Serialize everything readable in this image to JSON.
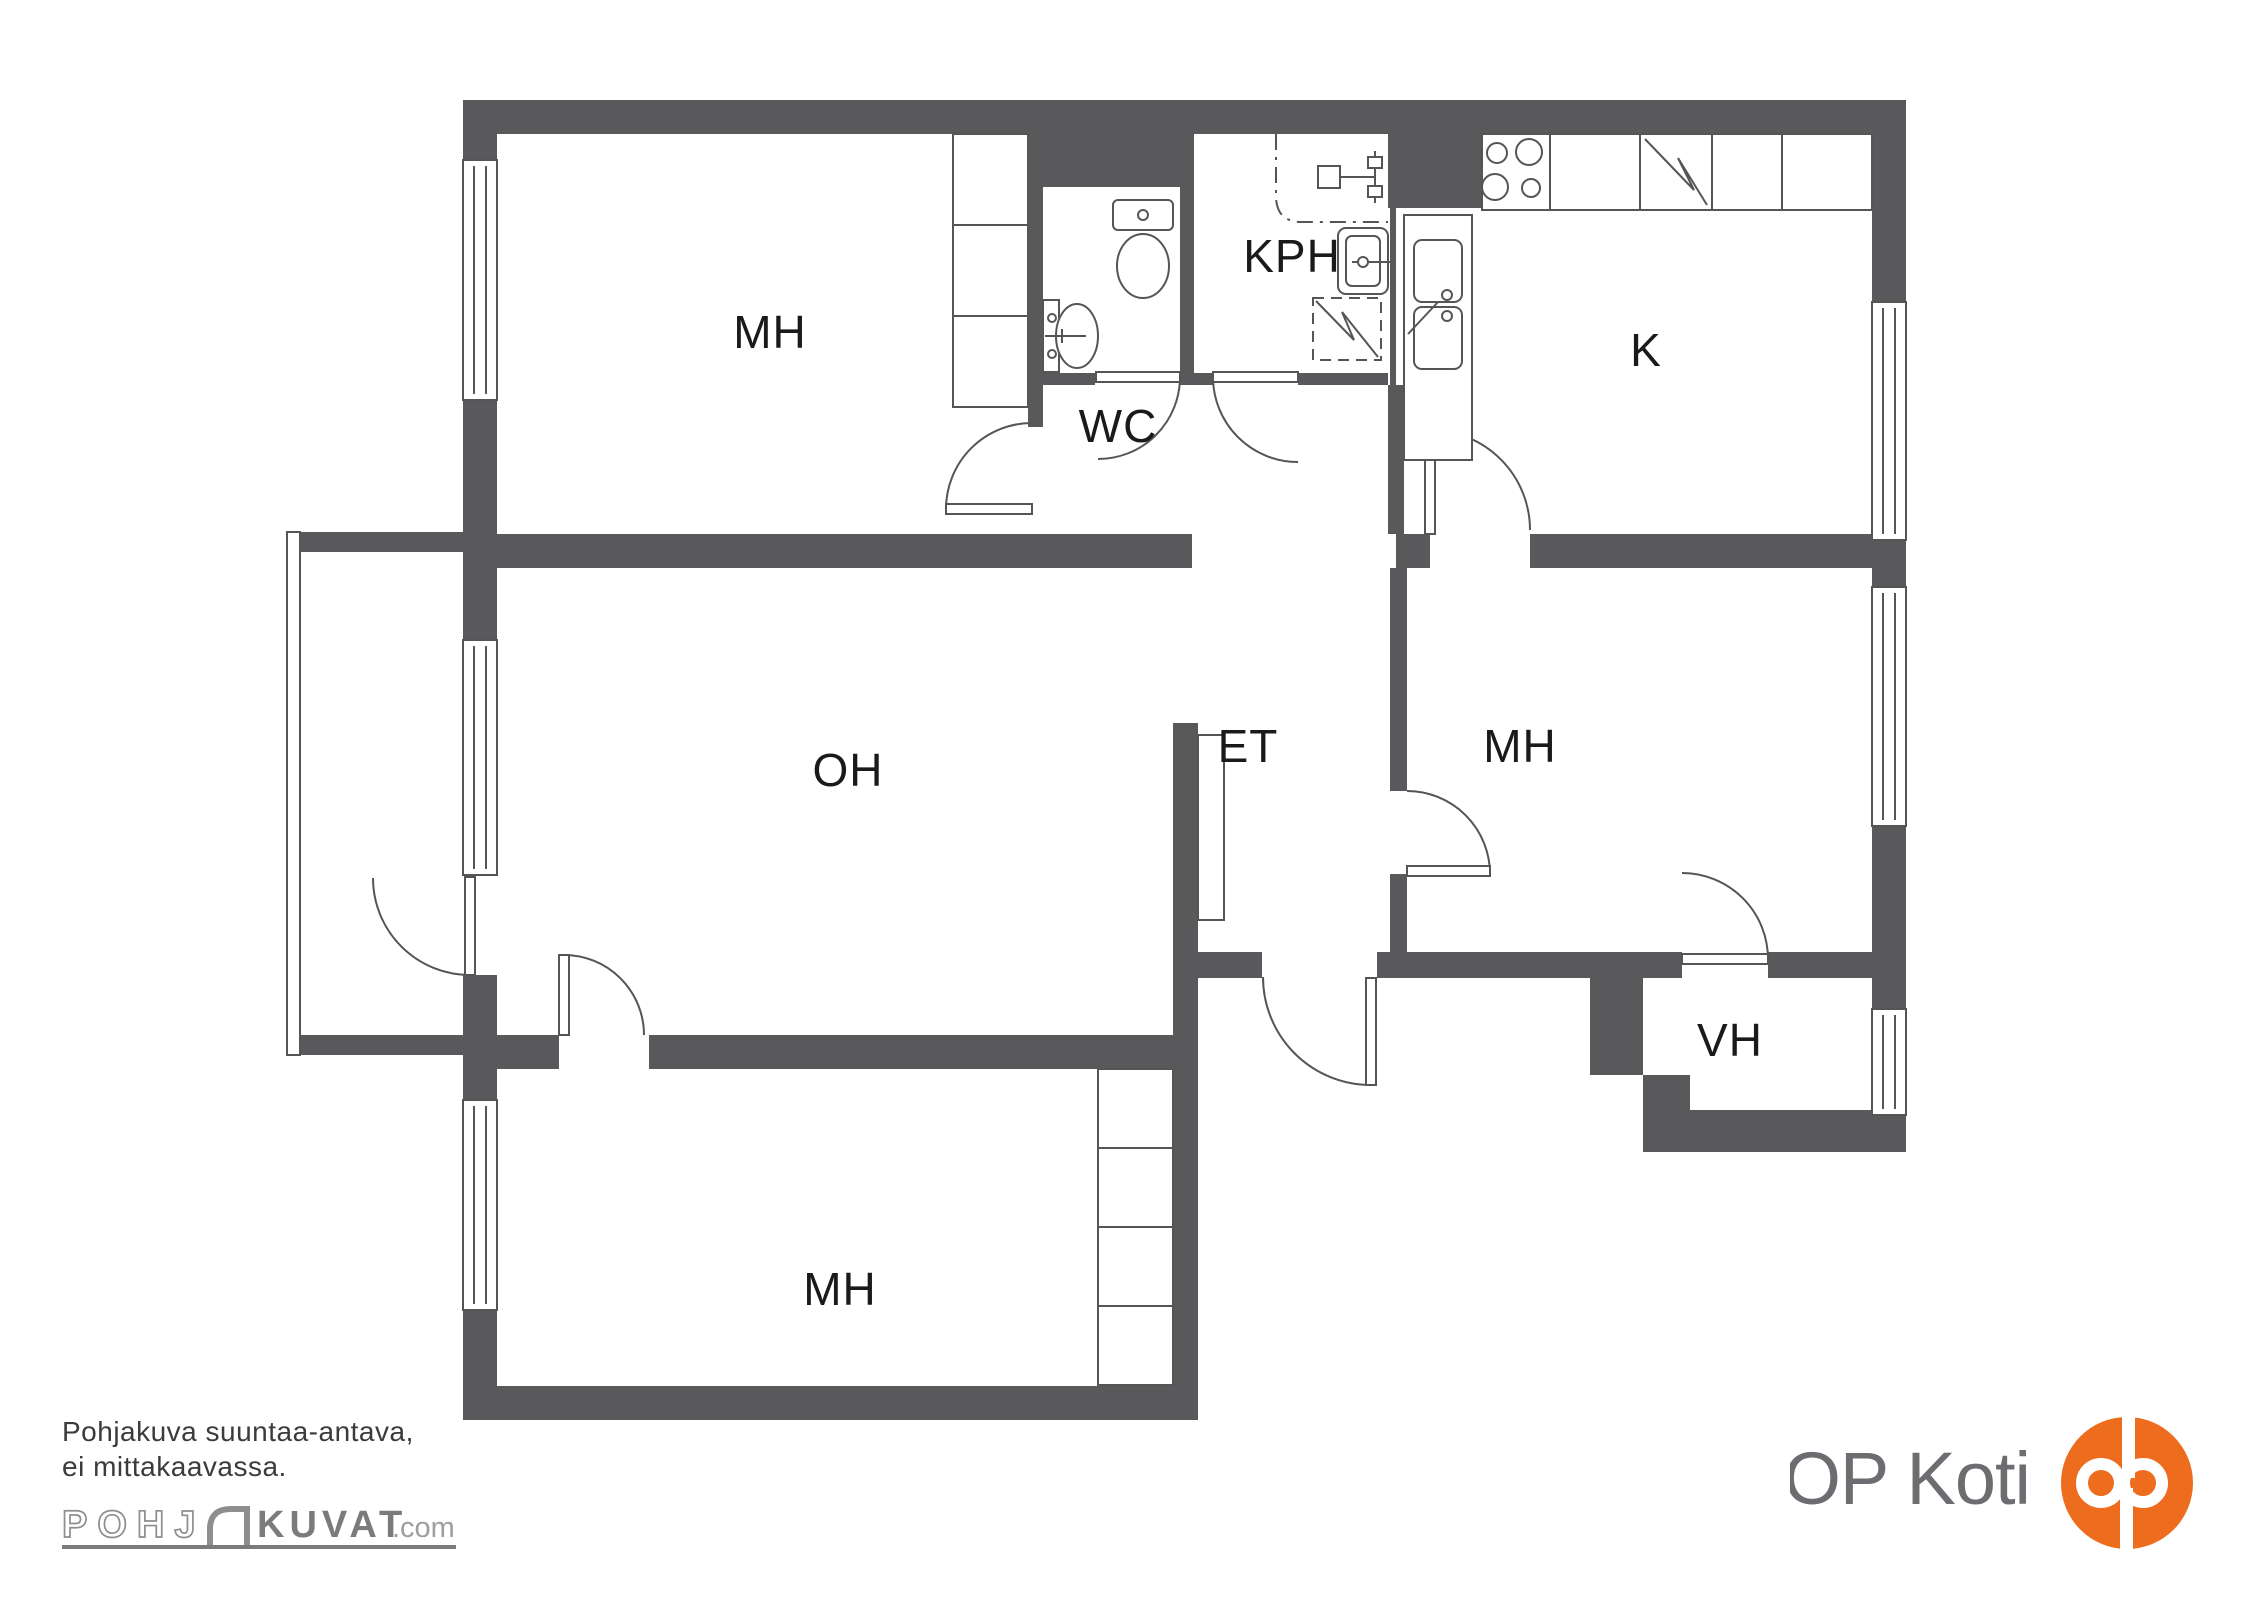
{
  "rooms": [
    {
      "id": "bedroom-top-left",
      "label": "MH"
    },
    {
      "id": "wc",
      "label": "WC"
    },
    {
      "id": "bathroom",
      "label": "KPH"
    },
    {
      "id": "kitchen",
      "label": "K"
    },
    {
      "id": "living-room",
      "label": "OH"
    },
    {
      "id": "entry-hall",
      "label": "ET"
    },
    {
      "id": "bedroom-right",
      "label": "MH"
    },
    {
      "id": "storage",
      "label": "VH"
    },
    {
      "id": "bedroom-bottom",
      "label": "MH"
    }
  ],
  "disclaimer": {
    "line1": "Pohjakuva suuntaa-antava,",
    "line2": "ei mittakaavassa."
  },
  "pohjakuvat_logo": {
    "part1": "POHJ",
    "part2": "KUVAT",
    "part3": ".com"
  },
  "op_logo": {
    "text": "OP Koti"
  },
  "colors": {
    "wall": "#59595b",
    "line": "#555555",
    "label": "#1a1a1a",
    "op_orange": "#ee6c1e",
    "op_text_gray": "#6c6d70",
    "logo_gray": "#7b7b7b"
  }
}
